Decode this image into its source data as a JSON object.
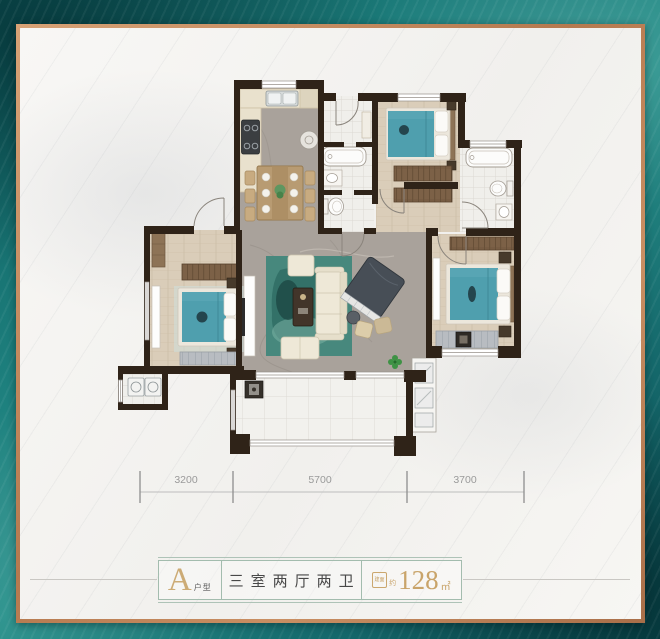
{
  "frame": {
    "background_teal": "#17706f",
    "border_copper": "#c08a62",
    "card_color": "#f5f4f1"
  },
  "floorplan": {
    "wall_color": "#2f2318",
    "furniture_teal": "#4f9fae",
    "rug_color": "#47887d",
    "wood_floor": "#dacdb9",
    "marble_floor": "#a9a29b",
    "dimensions": [
      "3200",
      "5700",
      "3700"
    ]
  },
  "info_bar": {
    "unit_letter": "A",
    "unit_suffix": "户型",
    "layout_text": "三室两厅两卫",
    "area_badge": "建面",
    "area_approx": "约",
    "area_value": "128",
    "area_unit": "㎡",
    "accent_color": "#c9a46a",
    "border_color": "#a3bcae"
  }
}
